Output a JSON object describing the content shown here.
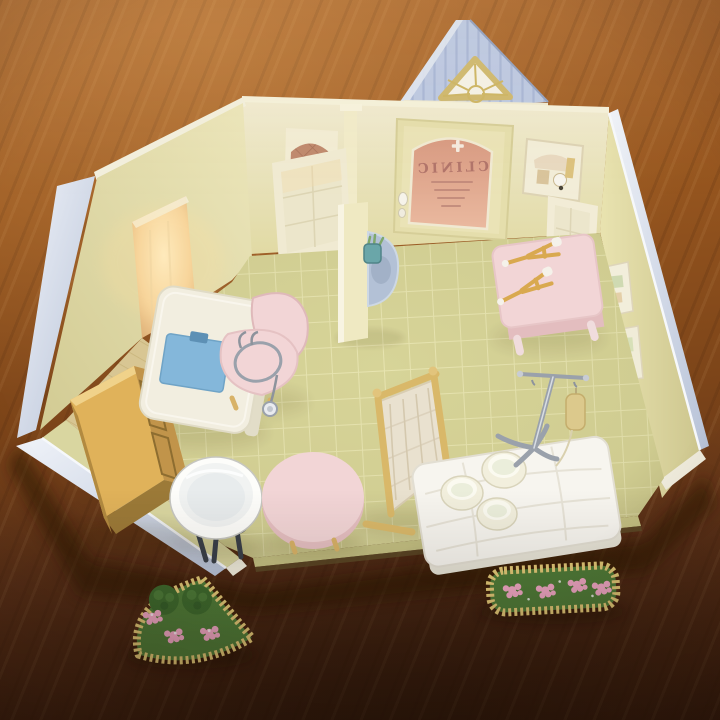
{
  "photo": {
    "subject": "Miniature toy clinic playset photographed on a wooden table",
    "door_sign": "CLINIC"
  },
  "colors": {
    "table_wood": "#8a5122",
    "roof_blue": "#bdc9e2",
    "wall_yellow": "#e9e3b2",
    "trim_blue": "#ccd5e5",
    "floor_tile": "#d7d498",
    "window_amber": "#c08a6e",
    "door_glass_salmon": "#dfa28f",
    "pink_furniture": "#f2d5d6",
    "clipboard_blue": "#84b7da",
    "sink_blue": "#b3c1d6",
    "crutch_tan": "#d9a94f",
    "cabinet_wood": "#e0b25a",
    "screen_frame_tan": "#d9b869",
    "bed_white": "#f7f5ef",
    "basin_white": "#fdfdfa",
    "chrome_gray": "#9aa1ab",
    "iv_bag_amber": "#dcc98c",
    "planter_border": "#e3c977",
    "planter_green": "#4f7c38",
    "flower_pink": "#f2a9c6"
  },
  "objects": [
    {
      "name": "roof-gable",
      "label": "blue gable roof with triangular sunburst window"
    },
    {
      "name": "clinic-door",
      "label": "arched glass door with mirrored CLINIC sign"
    },
    {
      "name": "wall-poster",
      "label": "small framed poster beside door"
    },
    {
      "name": "reception-desk",
      "label": "cream desk with blue clipboard"
    },
    {
      "name": "doctor-chair",
      "label": "pink chair with stethoscope"
    },
    {
      "name": "partition-sink",
      "label": "partition wall with blue sink and cup"
    },
    {
      "name": "waiting-bench",
      "label": "pink bench with two crutches"
    },
    {
      "name": "wooden-cabinet",
      "label": "wooden sideboard with sliding doors"
    },
    {
      "name": "wash-basin",
      "label": "white enamel basin on dark stand"
    },
    {
      "name": "round-stool",
      "label": "pink round stool"
    },
    {
      "name": "folding-screen",
      "label": "wooden privacy screen"
    },
    {
      "name": "examination-bed",
      "label": "white quilted bed with three bowls"
    },
    {
      "name": "iv-drip-stand",
      "label": "chrome IV stand with amber bag"
    },
    {
      "name": "flower-planter-fan",
      "label": "fan-shaped planter with bushes and pink flowers"
    },
    {
      "name": "flower-planter-rect",
      "label": "rectangular planter with pink flowers"
    }
  ]
}
